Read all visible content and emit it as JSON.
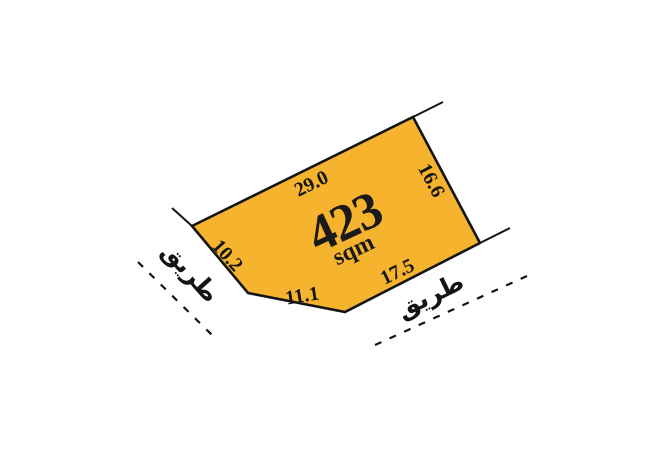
{
  "canvas": {
    "background_color": "#ffffff"
  },
  "plot": {
    "area_value": "423",
    "area_unit": "sqm",
    "fill_color": "#F5B32E",
    "stroke_color": "#141414",
    "edges": [
      {
        "side": "top",
        "length_label": "29.0"
      },
      {
        "side": "right",
        "length_label": "16.6"
      },
      {
        "side": "bottom-right",
        "length_label": "17.5"
      },
      {
        "side": "bottom",
        "length_label": "11.1"
      },
      {
        "side": "left",
        "length_label": "10.2"
      }
    ]
  },
  "roads": {
    "left": {
      "label": "طريق"
    },
    "right": {
      "label": "طريق"
    }
  }
}
